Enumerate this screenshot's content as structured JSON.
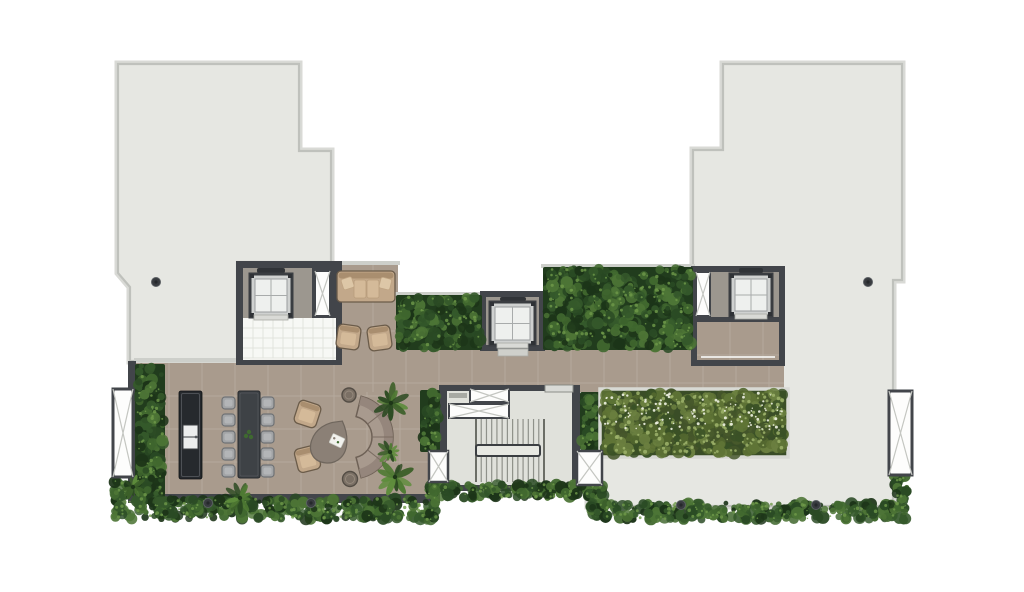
{
  "meta": {
    "title": "Roof terrace floor plan",
    "drawing_type": "architectural-floor-plan"
  },
  "palette": {
    "bg": "#ffffff",
    "roofFill": "#e6e7e2",
    "roofEdge": "#bfc1bc",
    "roofHalo": "#d9dad6",
    "tan": "#a99b8d",
    "tanGrid": "rgba(255,255,255,0.14)",
    "wall": "#42454a",
    "parapet": "#cdcfca",
    "liftFloor": "#9c978f",
    "tileWhite": "#f7f8f5",
    "tileLine": "#e2e3dd",
    "stairFloor": "#e0e1db",
    "stairLine": "#8f918a",
    "stairEdge": "#6c6e67",
    "carFrame": "#3a3d41",
    "carBody": "#cfd1d0",
    "carIn": "#eef0ee",
    "carGrid": "#a8abab",
    "lintel": "#303337",
    "sill": "#d9dad6",
    "doorLine": "#eff0ec",
    "ventWhite": "#fdfdfc",
    "ventX": "#c4c6c1",
    "planterFrame": "#d8d9d4",
    "hedgeDarkBase": "#213c1d",
    "hedgeDark": [
      "#2a4a24",
      "#35592b",
      "#41682f",
      "#1c3418",
      "#4d7536"
    ],
    "hedgeDot": "#6f9a4a",
    "hedgeBrightBase": "#3a4d27",
    "hedgeBright": [
      "#44552a",
      "#52662e",
      "#5f7436",
      "#6b8040",
      "#3a5126"
    ],
    "brightFleck": "#9db36b",
    "flower": "#eef2e2",
    "furnTan": "#c2a88a",
    "furnTanHi": "#d4ba99",
    "furnTanBack": "#a98e6f",
    "furnTanEdge": "#6b5c4a",
    "pillow": "#ddc7a7",
    "chair": "#a2a4a6",
    "chairIn": "#b3b5b7",
    "chairEdge": "#6f7275",
    "tableDark": "#3e4246",
    "islandDark": "#26292d",
    "curvedBack": "#93857b",
    "curvedSeat": "#a89a8e",
    "curvedEdge": "#6e6156",
    "stool": "#7b7065",
    "stoolEdge": "#544d45",
    "teardrop": "#8b8076",
    "teardropEdge": "#6f665d",
    "drain": "#383b3f",
    "plantGreens": [
      "#2c4a22",
      "#3c6029",
      "#4f7a33",
      "#5e8c3c"
    ]
  },
  "plan": {
    "canvas": {
      "w": 1024,
      "h": 592
    },
    "roofs": [
      {
        "name": "roof-wing-west",
        "points": [
          [
            118,
            64
          ],
          [
            299,
            64
          ],
          [
            299,
            151
          ],
          [
            331,
            151
          ],
          [
            331,
            262
          ],
          [
            237,
            262
          ],
          [
            237,
            361
          ],
          [
            130,
            361
          ],
          [
            130,
            287
          ],
          [
            118,
            273
          ]
        ]
      },
      {
        "name": "roof-wing-east",
        "points": [
          [
            723,
            64
          ],
          [
            902,
            64
          ],
          [
            902,
            280
          ],
          [
            893,
            280
          ],
          [
            893,
            506
          ],
          [
            588,
            506
          ],
          [
            588,
            388
          ],
          [
            693,
            388
          ],
          [
            693,
            150
          ],
          [
            723,
            150
          ]
        ]
      }
    ],
    "floors": [
      {
        "name": "terrace-floor",
        "x": 136,
        "y": 363,
        "w": 304,
        "h": 132
      },
      {
        "name": "sofa-nook-floor",
        "x": 340,
        "y": 265,
        "w": 58,
        "h": 98
      },
      {
        "name": "corridor-floor",
        "x": 340,
        "y": 350,
        "w": 444,
        "h": 42
      }
    ],
    "parapets": [
      {
        "name": "nook-parapet",
        "x": 338,
        "y": 261,
        "w": 62,
        "h": 4
      },
      {
        "name": "hedge-west-parapet",
        "x": 394,
        "y": 292,
        "w": 90,
        "h": 4
      },
      {
        "name": "hedge-east-parapet",
        "x": 541,
        "y": 264,
        "w": 154,
        "h": 4
      },
      {
        "name": "terrace-top-parapet",
        "x": 134,
        "y": 358,
        "w": 104,
        "h": 4
      }
    ],
    "walls": [
      {
        "name": "lift-core-west-walls",
        "x": 236,
        "y": 261,
        "w": 106,
        "h": 104
      },
      {
        "name": "lift-core-central-walls",
        "x": 480,
        "y": 291,
        "w": 65,
        "h": 60
      },
      {
        "name": "lift-core-east-walls",
        "x": 691,
        "y": 266,
        "w": 94,
        "h": 100
      },
      {
        "name": "stair-core-walls",
        "x": 439,
        "y": 385,
        "w": 141,
        "h": 106
      },
      {
        "name": "terrace-west-wall",
        "x": 128,
        "y": 361,
        "w": 8,
        "h": 142
      },
      {
        "name": "terrace-south-wall",
        "x": 128,
        "y": 494,
        "w": 312,
        "h": 9
      }
    ],
    "lifts": [
      {
        "name": "lift-west",
        "room": {
          "x": 243,
          "y": 268,
          "w": 69,
          "h": 50
        },
        "duct": {
          "x": 315,
          "y": 271,
          "w": 15,
          "h": 45
        },
        "car": {
          "x": 250,
          "y": 274,
          "w": 42,
          "h": 43
        },
        "lintel": {
          "x": 257,
          "y": 268,
          "w": 28,
          "h": 5
        },
        "sill": {
          "x": 254,
          "y": 315,
          "w": 34,
          "h": 5
        },
        "lobby": {
          "x": 243,
          "y": 318,
          "w": 93,
          "h": 42,
          "style": "tiles"
        },
        "door": {
          "x": 250,
          "y": 358,
          "w": 75
        }
      },
      {
        "name": "lift-central",
        "room": {
          "x": 486,
          "y": 297,
          "w": 53,
          "h": 48
        },
        "car": {
          "x": 490,
          "y": 302,
          "w": 45,
          "h": 43
        },
        "lintel": {
          "x": 500,
          "y": 297,
          "w": 26,
          "h": 4
        },
        "sill": {
          "x": 497,
          "y": 343,
          "w": 31,
          "h": 5
        },
        "step": {
          "x": 498,
          "y": 349,
          "w": 30,
          "h": 7
        }
      },
      {
        "name": "lift-east",
        "room": {
          "x": 697,
          "y": 272,
          "w": 82,
          "h": 45
        },
        "duct": {
          "x": 696,
          "y": 272,
          "w": 14,
          "h": 44
        },
        "car": {
          "x": 730,
          "y": 274,
          "w": 42,
          "h": 42
        },
        "lintel": {
          "x": 739,
          "y": 268,
          "w": 24,
          "h": 5
        },
        "sill": {
          "x": 735,
          "y": 314,
          "w": 32,
          "h": 5
        },
        "lobby": {
          "x": 697,
          "y": 322,
          "w": 82,
          "h": 38,
          "style": "tan"
        },
        "door": {
          "x": 701,
          "y": 356,
          "w": 74
        }
      }
    ],
    "stair": {
      "name": "stair-core",
      "room": {
        "x": 447,
        "y": 391,
        "w": 125,
        "h": 94
      },
      "ducts": [
        {
          "name": "stair-duct-a",
          "x": 470,
          "y": 389,
          "w": 39,
          "h": 13
        },
        {
          "name": "stair-duct-b",
          "x": 449,
          "y": 404,
          "w": 60,
          "h": 14
        }
      ],
      "bar": {
        "x": 449,
        "y": 393,
        "w": 18,
        "h": 5
      },
      "landing": {
        "x": 545,
        "y": 385,
        "w": 28,
        "h": 7
      },
      "flight": {
        "x": 476,
        "y": 419,
        "w": 68,
        "h": 63,
        "treads": 13
      },
      "rail": {
        "x": 476,
        "y": 445,
        "w": 64,
        "h": 11
      }
    },
    "hedges": [
      {
        "name": "hedge-center-west",
        "x": 396,
        "y": 295,
        "w": 86,
        "h": 55,
        "style": "dark",
        "soft": false
      },
      {
        "name": "hedge-center-east",
        "x": 543,
        "y": 267,
        "w": 150,
        "h": 83,
        "style": "dark",
        "soft": false
      },
      {
        "name": "terrace-planting-bed",
        "x": 135,
        "y": 364,
        "w": 30,
        "h": 140,
        "style": "dark",
        "soft": false
      },
      {
        "name": "hedge-by-stair",
        "x": 420,
        "y": 390,
        "w": 20,
        "h": 62,
        "style": "dark",
        "soft": false
      },
      {
        "name": "hedge-by-planter",
        "x": 580,
        "y": 392,
        "w": 20,
        "h": 58,
        "style": "dark",
        "soft": false
      },
      {
        "name": "hedge-south-west",
        "x": 112,
        "y": 497,
        "w": 326,
        "h": 24,
        "style": "dark",
        "soft": true
      },
      {
        "name": "hedge-south-west-corner",
        "x": 112,
        "y": 477,
        "w": 18,
        "h": 26,
        "style": "dark",
        "soft": true
      },
      {
        "name": "hedge-south-center",
        "x": 424,
        "y": 482,
        "w": 182,
        "h": 18,
        "style": "dark",
        "soft": true
      },
      {
        "name": "hedge-south-center-left",
        "x": 424,
        "y": 482,
        "w": 14,
        "h": 42,
        "style": "dark",
        "soft": true
      },
      {
        "name": "hedge-south-center-right",
        "x": 590,
        "y": 482,
        "w": 16,
        "h": 38,
        "style": "dark",
        "soft": true
      },
      {
        "name": "hedge-south-east",
        "x": 588,
        "y": 501,
        "w": 320,
        "h": 21,
        "style": "dark",
        "soft": true
      },
      {
        "name": "hedge-east-corner",
        "x": 891,
        "y": 473,
        "w": 18,
        "h": 33,
        "style": "dark",
        "soft": true
      }
    ],
    "planters": [
      {
        "name": "planter-east",
        "x": 600,
        "y": 389,
        "w": 188,
        "h": 68
      }
    ],
    "vents": [
      {
        "name": "vent-west-louvre",
        "x": 113,
        "y": 389,
        "w": 20,
        "h": 88,
        "sw": 3
      },
      {
        "name": "vent-east-louvre",
        "x": 889,
        "y": 391,
        "w": 23,
        "h": 84,
        "sw": 3
      },
      {
        "name": "vent-stair-sw",
        "x": 429,
        "y": 451,
        "w": 19,
        "h": 31,
        "sw": 2.5
      },
      {
        "name": "vent-stair-se",
        "x": 577,
        "y": 451,
        "w": 25,
        "h": 34,
        "sw": 2.5
      }
    ],
    "furniture": {
      "island": {
        "x": 179,
        "y": 391,
        "w": 23,
        "h": 88,
        "sink": {
          "x": 183,
          "y": 425,
          "w": 15,
          "h": 24
        }
      },
      "diningTable": {
        "x": 238,
        "y": 391,
        "w": 22,
        "h": 87
      },
      "chairRows": [
        397,
        414,
        431,
        448,
        465
      ],
      "chairCols": [
        222,
        261
      ],
      "chairSize": {
        "w": 13,
        "h": 12
      },
      "sofa": {
        "x": 337,
        "y": 271,
        "w": 58,
        "h": 31
      },
      "armchairs": [
        {
          "x": 337,
          "y": 325,
          "rot": 8
        },
        {
          "x": 368,
          "y": 326,
          "rot": -8
        },
        {
          "x": 296,
          "y": 402,
          "rot": 18
        },
        {
          "x": 296,
          "y": 447,
          "rot": -14
        }
      ],
      "armchairSize": {
        "w": 23,
        "h": 24
      },
      "coffeeTable": {
        "x": 333,
        "y": 441,
        "rot": 25
      },
      "curvedSofa": {
        "cx": 351,
        "cy": 437,
        "rOuter": 42,
        "rMid": 33,
        "rInner": 21,
        "a1": -76,
        "a2": 76,
        "seams": [
          -38,
          0,
          38
        ]
      },
      "stools": [
        {
          "x": 349,
          "y": 395,
          "r": 7
        },
        {
          "x": 350,
          "y": 479,
          "r": 7.5
        }
      ]
    },
    "plants": [
      {
        "x": 391,
        "y": 403,
        "r": 17
      },
      {
        "x": 395,
        "y": 477,
        "r": 16
      },
      {
        "x": 390,
        "y": 452,
        "r": 11
      },
      {
        "x": 240,
        "y": 498,
        "r": 13
      },
      {
        "x": 133,
        "y": 487,
        "r": 11
      }
    ],
    "drains": [
      [
        156,
        282
      ],
      [
        868,
        282
      ],
      [
        208,
        503
      ],
      [
        311,
        503
      ],
      [
        681,
        505
      ],
      [
        816,
        505
      ]
    ],
    "inventory": {
      "lifts": 3,
      "stair_flights": 2,
      "dining_chairs": 10,
      "lounge_armchairs": 4,
      "sofas": 2,
      "vent_louvres": 4,
      "roof_drains": 6
    }
  }
}
